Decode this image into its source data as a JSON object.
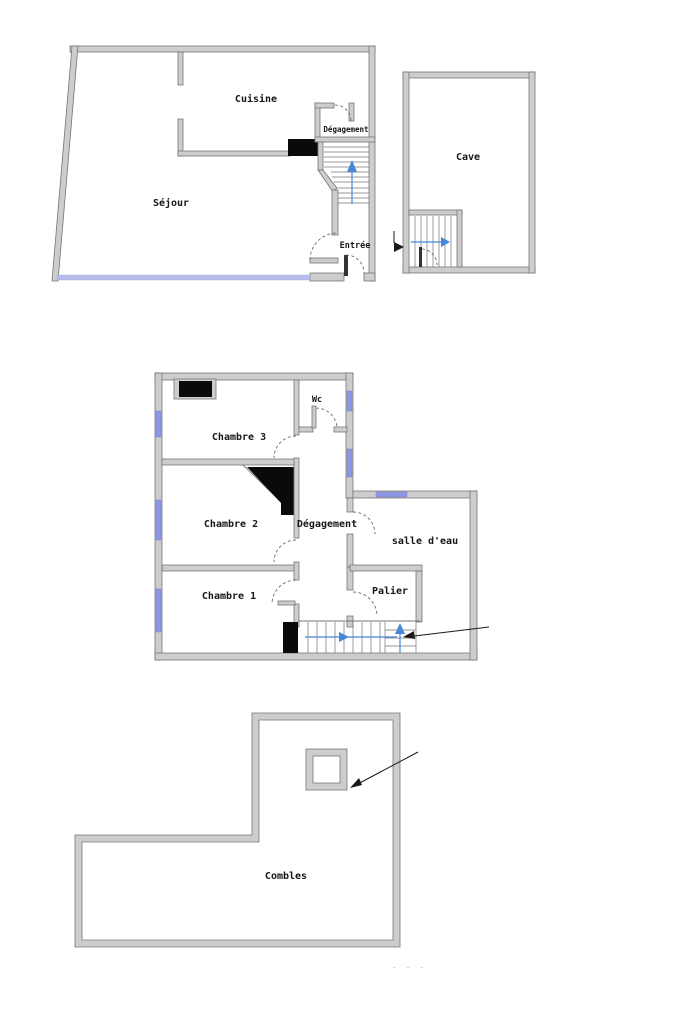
{
  "document": {
    "type": "floor-plan-drawing",
    "footer_mark": "- - -"
  },
  "colors": {
    "background": "#ffffff",
    "wall_fill": "#cdcdcd",
    "wall_stroke": "#757575",
    "window_blue": "#8d97e3",
    "bay_window_blue": "#b8bcec",
    "stair_arrow_blue": "#4586d7",
    "chimney_black": "#0a0a0a",
    "ink": "#161616"
  },
  "floors": {
    "ground": {
      "rooms": {
        "sejour": "Séjour",
        "cuisine": "Cuisine",
        "degagement": "Dégagement",
        "entree": "Entrée"
      },
      "annotations": [
        "stair-up-arrow",
        "entry-door-arcs",
        "bay-window-front"
      ]
    },
    "cave": {
      "rooms": {
        "cave": "Cave"
      },
      "annotations": [
        "stair-direction-arrow",
        "entrance-arrow-marker",
        "door-arc"
      ]
    },
    "first": {
      "rooms": {
        "chambre3": "Chambre 3",
        "wc": "Wc",
        "chambre2": "Chambre 2",
        "degagement": "Dégagement",
        "salle_deau": "salle d'eau",
        "chambre1": "Chambre 1",
        "palier": "Palier"
      },
      "annotations": [
        "stair-run-arrow",
        "stair-up-arrow",
        "pointer-arrow-to-stairs"
      ]
    },
    "attic": {
      "rooms": {
        "combles": "Combles"
      },
      "annotations": [
        "pointer-arrow-to-chimney-shaft"
      ]
    }
  }
}
